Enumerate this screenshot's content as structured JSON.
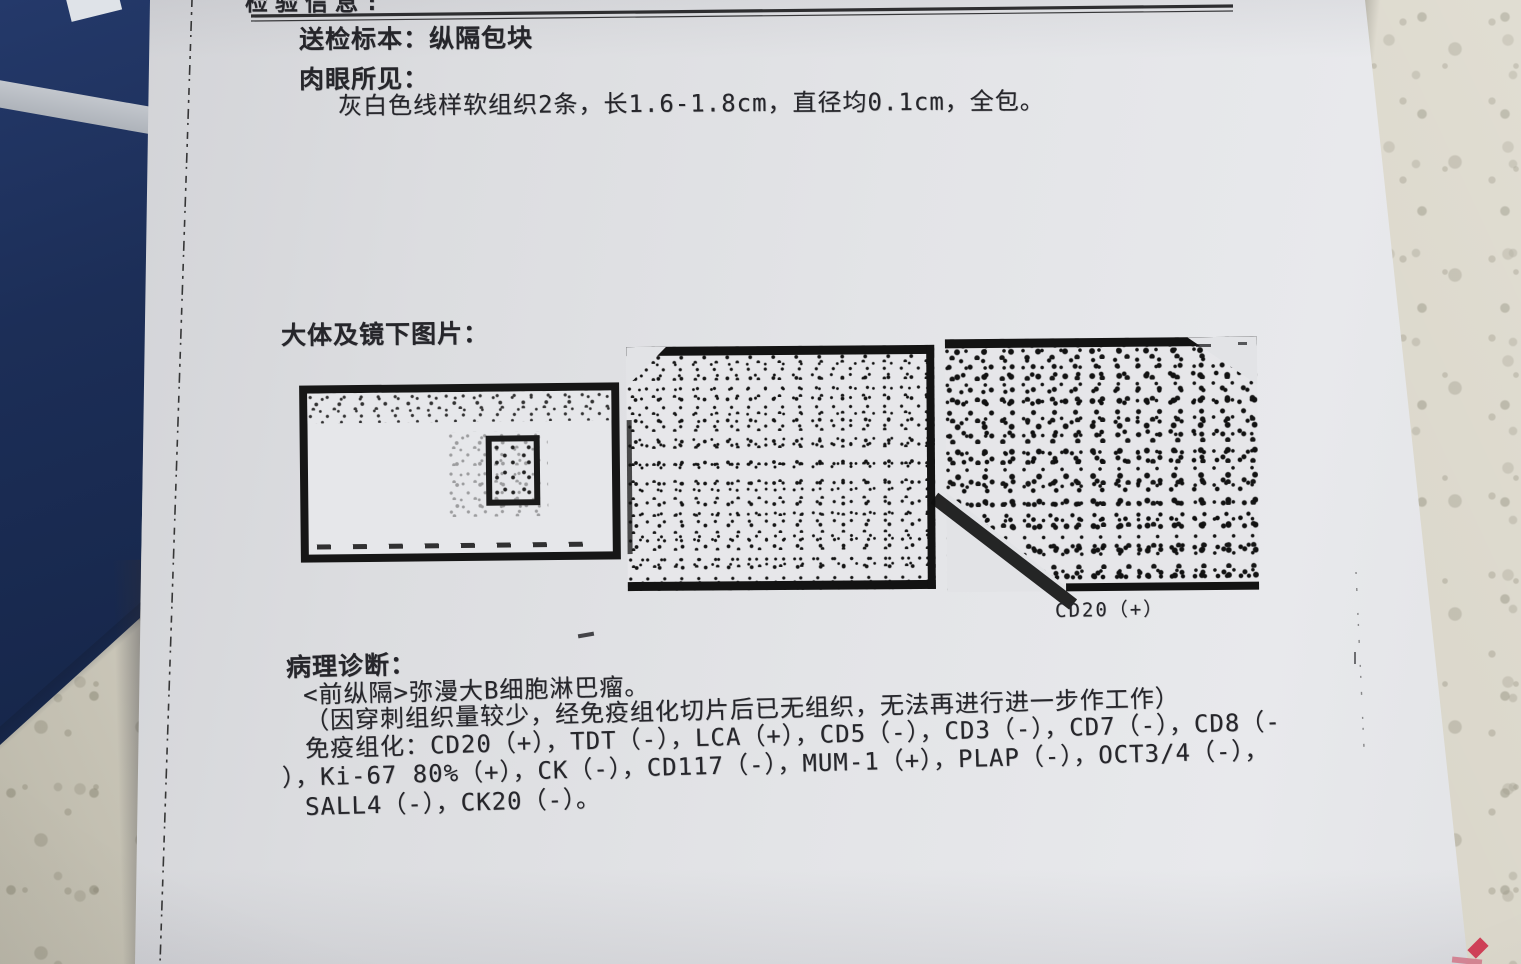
{
  "scene": {
    "description": "Photograph of a printed Chinese pathology report page lying on a speckled stone countertop, dark-blue folder at upper left, small red diamond mark at lower-right paper edge",
    "colors": {
      "folder_blue": "#1c2e57",
      "folder_stripe": "#c3c7cd",
      "countertop": "#d8d4c7",
      "paper": "#e3e4e7",
      "ink": "#26262b",
      "red_mark": "#cf4057"
    }
  },
  "report": {
    "clipped_top_text": "检验信息:",
    "specimen_line": "送检标本：纵隔包块",
    "gross_heading": "肉眼所见：",
    "gross_finding": "灰白色线样软组织2条，长1.6-1.8cm，直径均0.1cm，全包。",
    "images_heading": "大体及镜下图片：",
    "figures": [
      {
        "name": "gross-specimen-photo"
      },
      {
        "name": "microscopic-image-1"
      },
      {
        "name": "microscopic-image-2",
        "caption": "CD20（+）"
      }
    ],
    "diagnosis_heading": "病理诊断：",
    "diagnosis_site_line": "<前纵隔>弥漫大B细胞淋巴瘤。",
    "diagnosis_note_line": "（因穿刺组织量较少，经免疫组化切片后已无组织，无法再进行进一步作工作）",
    "ihc_line1": "免疫组化：CD20（+），TDT（-），LCA（+），CD5（-），CD3（-），CD7（-），CD8（-",
    "ihc_line2": "），Ki-67 80%（+），CK（-），CD117（-），MUM-1（+），PLAP（-），OCT3/4（-），",
    "ihc_line3": "SALL4（-），CK20（-）。"
  }
}
